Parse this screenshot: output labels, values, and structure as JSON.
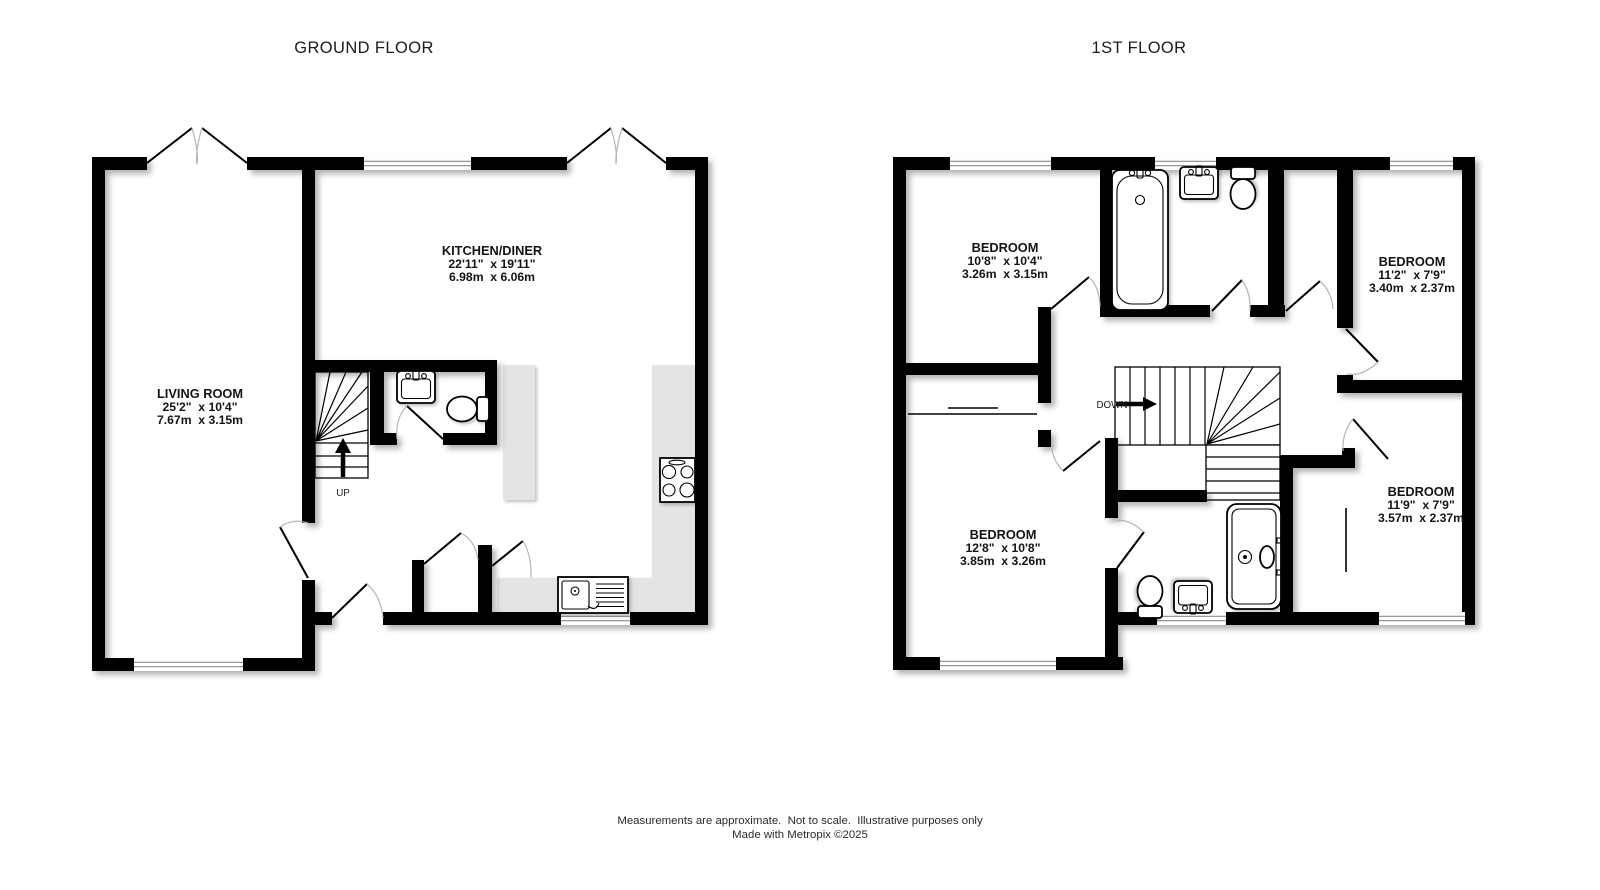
{
  "titles": {
    "ground": "GROUND FLOOR",
    "first": "1ST FLOOR"
  },
  "rooms": {
    "living_room": {
      "name": "LIVING ROOM",
      "imperial": "25'2\"  x 10'4\"",
      "metric": "7.67m  x 3.15m"
    },
    "kitchen_diner": {
      "name": "KITCHEN/DINER",
      "imperial": "22'11\"  x 19'11\"",
      "metric": "6.98m  x 6.06m"
    },
    "bedroom_1": {
      "name": "BEDROOM",
      "imperial": "10'8\"  x 10'4\"",
      "metric": "3.26m  x 3.15m"
    },
    "bedroom_2": {
      "name": "BEDROOM",
      "imperial": "11'2\"  x 7'9\"",
      "metric": "3.40m  x 2.37m"
    },
    "bedroom_3": {
      "name": "BEDROOM",
      "imperial": "12'8\"  x 10'8\"",
      "metric": "3.85m  x 3.26m"
    },
    "bedroom_4": {
      "name": "BEDROOM",
      "imperial": "11'9\"  x 7'9\"",
      "metric": "3.57m  x 2.37m"
    }
  },
  "stairs": {
    "up_label": "UP",
    "down_label": "DOWN"
  },
  "footer": {
    "line1": "Measurements are approximate.  Not to scale.  Illustrative purposes only",
    "line2": "Made with Metropix ©2025"
  },
  "colors": {
    "wall": "#000000",
    "counter": "#e4e4e4",
    "window_line": "#8a8a8a",
    "door_arc": "#b5b5b5",
    "label_text": "#141414",
    "footer_text": "#2a2a2a",
    "background": "#ffffff"
  },
  "icons": {
    "bath": "bath-icon",
    "shower": "shower-icon",
    "toilet": "toilet-icon",
    "sink": "sink-icon",
    "hob": "hob-icon",
    "kitchen_sink": "kitchen-sink-icon",
    "stairs_up_arrow": "up-arrow-icon",
    "stairs_down_arrow": "down-arrow-icon"
  }
}
